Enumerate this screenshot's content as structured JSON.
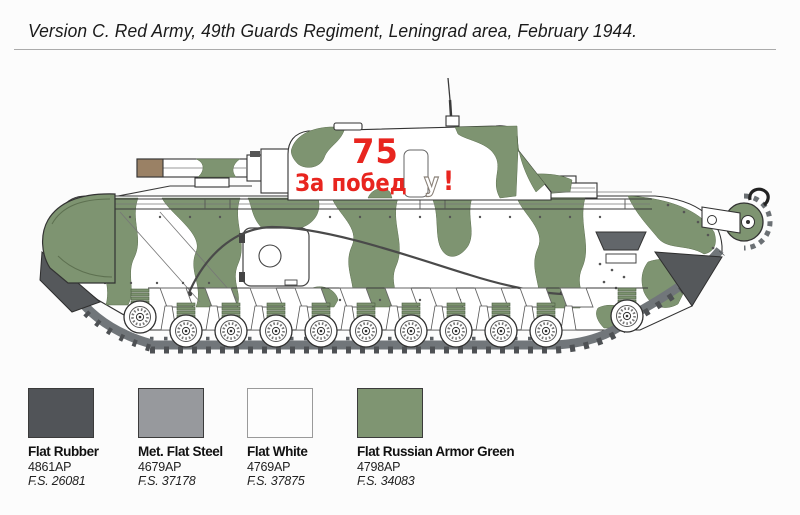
{
  "title": "Version C. Red Army, 49th Guards Regiment, Leningrad area, February 1944.",
  "illustration": {
    "markings": {
      "turret_number": "75",
      "slogan_part1": "За побед",
      "slogan_overlap_letter": "у",
      "slogan_exclamation": "!"
    },
    "colors": {
      "camo_green": "#7e9471",
      "hull_white": "#ffffff",
      "track_gray": "#71767a",
      "cleat_gray": "#4e5154",
      "deflector_gray": "#55585b",
      "barrel_tip_brown": "#9a8165",
      "marking_red": "#e8251f",
      "outline": "#333333"
    }
  },
  "legend": {
    "swatches": [
      {
        "name": "Flat Rubber",
        "code": "4861AP",
        "fs": "F.S. 26081",
        "hex": "#515458"
      },
      {
        "name": "Met. Flat Steel",
        "code": "4679AP",
        "fs": "F.S. 37178",
        "hex": "#97999d"
      },
      {
        "name": "Flat White",
        "code": "4769AP",
        "fs": "F.S. 37875",
        "hex": "#fdfdfd"
      },
      {
        "name": "Flat Russian Armor Green",
        "code": "4798AP",
        "fs": "F.S. 34083",
        "hex": "#7f9572"
      }
    ]
  }
}
